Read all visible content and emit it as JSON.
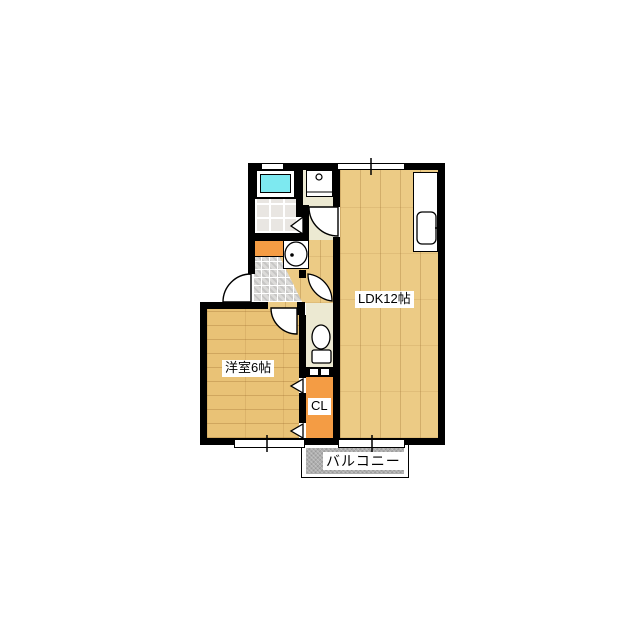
{
  "plan": {
    "rooms": {
      "ldk": {
        "label": "LDK12帖"
      },
      "western_room": {
        "label": "洋室6帖"
      },
      "closet": {
        "label": "CL"
      },
      "balcony": {
        "label": "バルコニー"
      }
    },
    "fixtures": [
      "bathtub",
      "bathroom-tile",
      "washbasin",
      "wash-sink-unit",
      "toilet",
      "kitchen-counter-sink",
      "shoe-cabinet",
      "entrance-mosaic"
    ],
    "colors": {
      "wall": "#000000",
      "ldk_wood": "#ECCB85",
      "room_wood": "#E9C276",
      "closet_orange": "#F49C44",
      "bathtub_cyan": "#7DE9F0",
      "bath_tile": "#E9E6E2",
      "entrance_mosaic": "#DCDBD9",
      "pale_floor": "#ECE9D2",
      "balcony_gray": "#AEAEAE"
    }
  }
}
